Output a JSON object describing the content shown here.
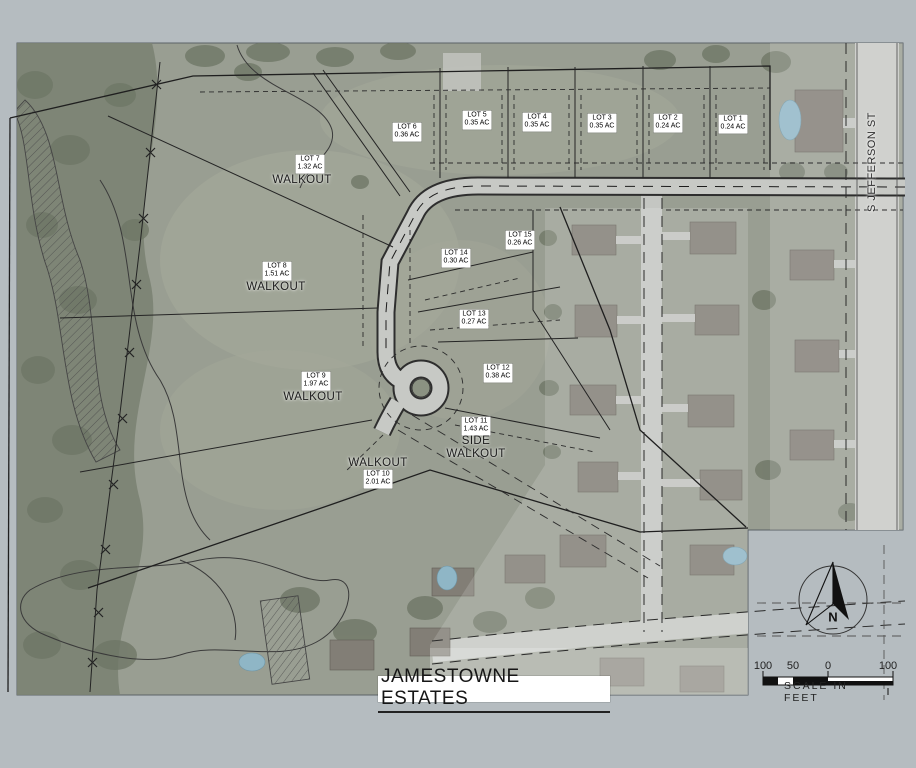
{
  "map": {
    "title": "JAMESTOWNE ESTATES",
    "street_label": "S JEFFERSON ST",
    "compass_label": "N",
    "scale_bar": {
      "labels": [
        "100",
        "50",
        "0",
        "100"
      ],
      "caption": "SCALE IN FEET"
    },
    "lots": [
      {
        "name": "LOT 1",
        "area": "0.24 AC"
      },
      {
        "name": "LOT 2",
        "area": "0.24 AC"
      },
      {
        "name": "LOT 3",
        "area": "0.35 AC"
      },
      {
        "name": "LOT 4",
        "area": "0.35 AC"
      },
      {
        "name": "LOT 5",
        "area": "0.35 AC"
      },
      {
        "name": "LOT 6",
        "area": "0.36 AC"
      },
      {
        "name": "LOT 7",
        "area": "1.32 AC",
        "note": "WALKOUT"
      },
      {
        "name": "LOT 8",
        "area": "1.51 AC",
        "note": "WALKOUT"
      },
      {
        "name": "LOT 9",
        "area": "1.97 AC",
        "note": "WALKOUT"
      },
      {
        "name": "LOT 10",
        "area": "2.01 AC",
        "note": "WALKOUT"
      },
      {
        "name": "LOT 11",
        "area": "1.43 AC",
        "note": "SIDE WALKOUT"
      },
      {
        "name": "LOT 12",
        "area": "0.38 AC"
      },
      {
        "name": "LOT 13",
        "area": "0.27 AC"
      },
      {
        "name": "LOT 14",
        "area": "0.30 AC"
      },
      {
        "name": "LOT 15",
        "area": "0.26 AC"
      }
    ]
  },
  "colors": {
    "background": "#b5bcc0",
    "photo_base": "#999e92",
    "woods": "#7b8273",
    "road": "#c7c9c5",
    "linework": "#1f1f1f",
    "pool": "#8fb6c6",
    "label_background": "#ffffff"
  }
}
